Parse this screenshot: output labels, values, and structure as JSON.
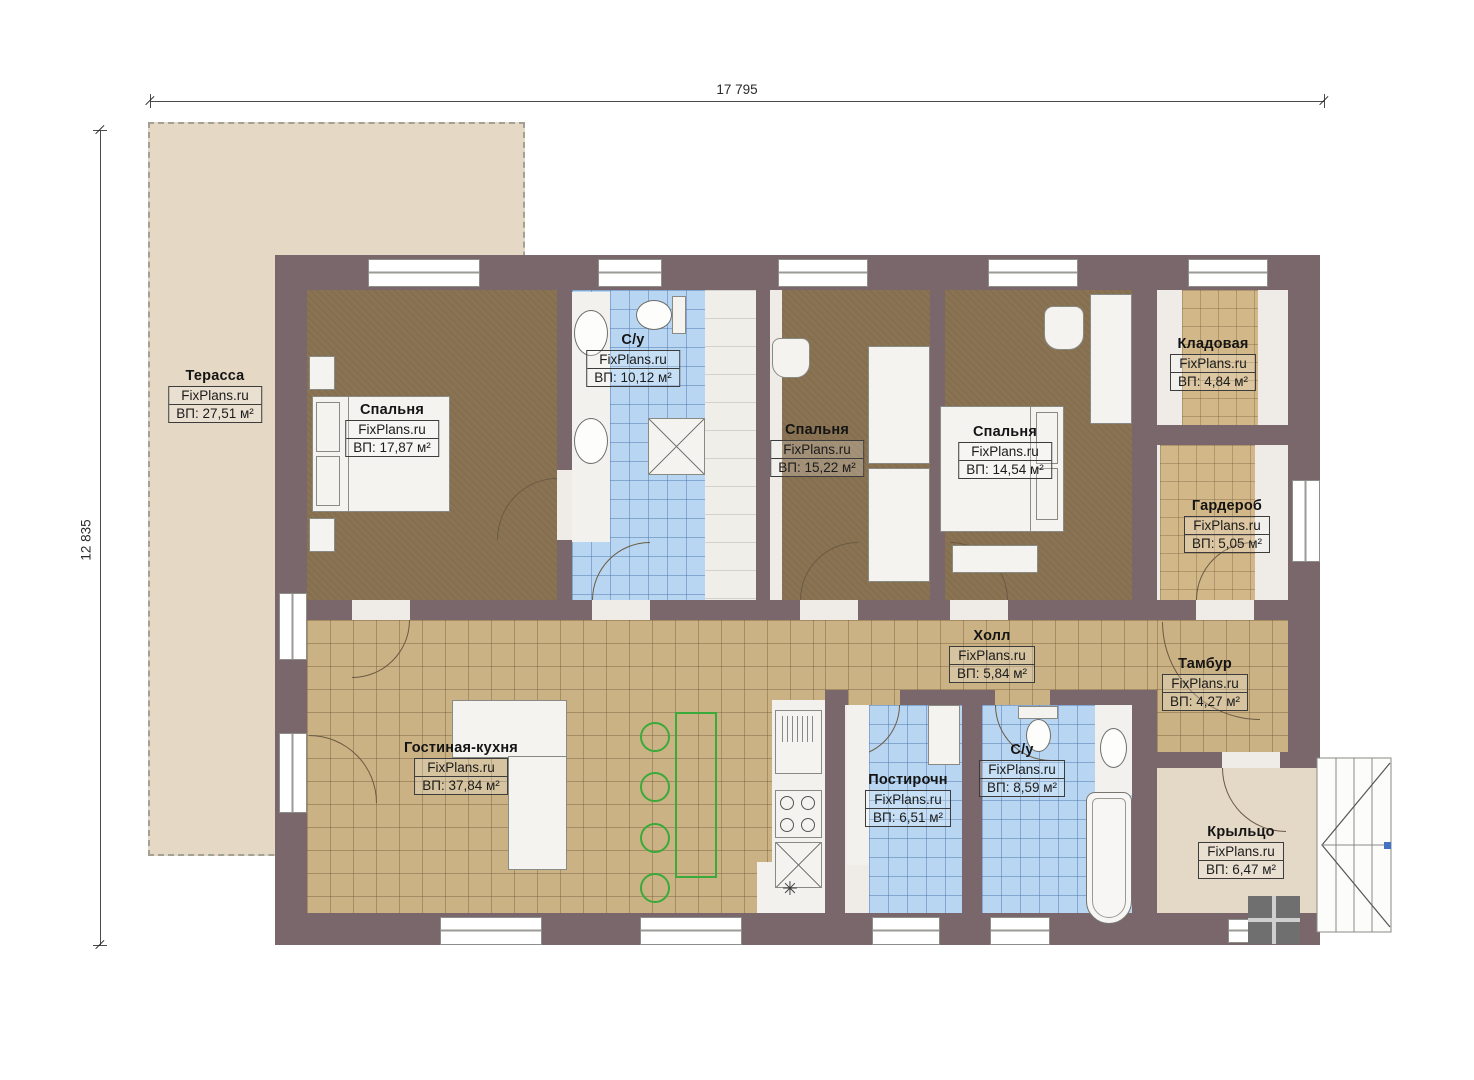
{
  "brand": "FixPlans.ru",
  "dimensions": {
    "top": "17 795",
    "left": "12 835"
  },
  "symbols": {
    "asterisk": "✳"
  },
  "colors": {
    "wall": "#7a676b",
    "bedroom_floor": "#897352",
    "tile_floor": "#cbb284",
    "bath_floor": "#b8d6f2",
    "terrace_floor": "#e5d8c4",
    "porch_floor": "#e4d8c6",
    "accent_green": "#3aaa3a"
  },
  "rooms": [
    {
      "id": "terrace",
      "name": "Терасса",
      "area": "ВП: 27,51 м²"
    },
    {
      "id": "bedroom1",
      "name": "Спальня",
      "area": "ВП: 17,87 м²"
    },
    {
      "id": "bath1",
      "name": "С/у",
      "area": "ВП: 10,12 м²"
    },
    {
      "id": "bedroom2",
      "name": "Спальня",
      "area": "ВП: 15,22 м²"
    },
    {
      "id": "bedroom3",
      "name": "Спальня",
      "area": "ВП: 14,54 м²"
    },
    {
      "id": "storage",
      "name": "Кладовая",
      "area": "ВП: 4,84 м²"
    },
    {
      "id": "wardrobe",
      "name": "Гардероб",
      "area": "ВП: 5,05 м²"
    },
    {
      "id": "hall",
      "name": "Холл",
      "area": "ВП: 5,84 м²"
    },
    {
      "id": "tambour",
      "name": "Тамбур",
      "area": "ВП: 4,27 м²"
    },
    {
      "id": "living",
      "name": "Гостиная-кухня",
      "area": "ВП: 37,84 м²"
    },
    {
      "id": "laundry",
      "name": "Постирочн",
      "area": "ВП: 6,51 м²"
    },
    {
      "id": "bath2",
      "name": "С/у",
      "area": "ВП: 8,59 м²"
    },
    {
      "id": "porch",
      "name": "Крыльцо",
      "area": "ВП: 6,47 м²"
    }
  ]
}
